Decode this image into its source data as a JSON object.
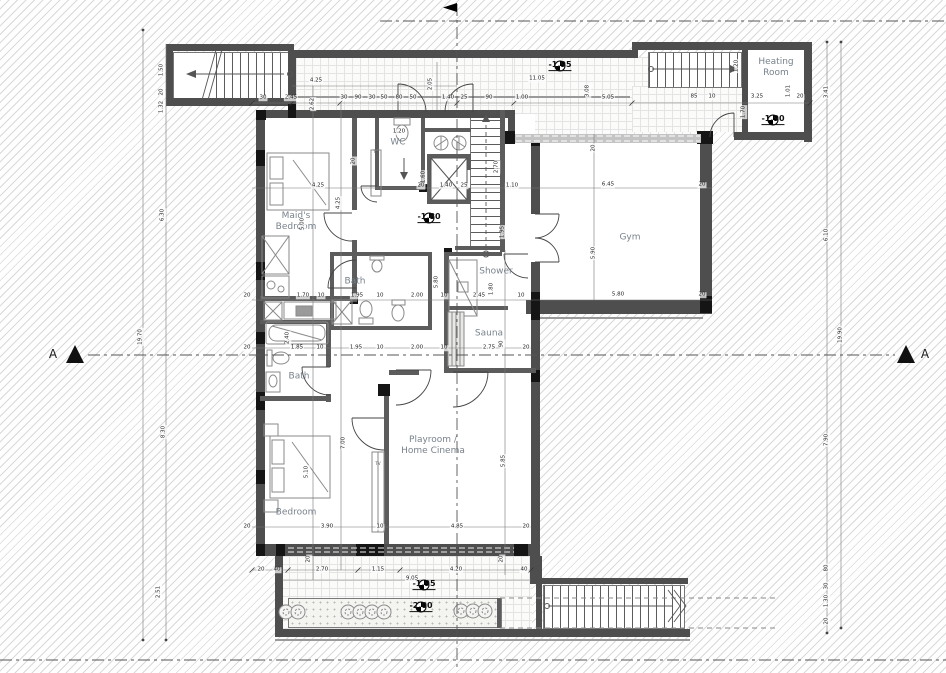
{
  "section_markers": {
    "left": "A",
    "right": "A"
  },
  "rooms": [
    {
      "id": "maids-bedroom",
      "label": "Maid's\nBedroom",
      "x": 296,
      "y": 222
    },
    {
      "id": "wc",
      "label": "WC",
      "x": 398,
      "y": 143
    },
    {
      "id": "bath-upper",
      "label": "Bath",
      "x": 355,
      "y": 282
    },
    {
      "id": "bath-lower",
      "label": "Bath",
      "x": 299,
      "y": 377
    },
    {
      "id": "shower",
      "label": "Shower",
      "x": 496,
      "y": 272
    },
    {
      "id": "sauna",
      "label": "Sauna",
      "x": 489,
      "y": 334
    },
    {
      "id": "gym",
      "label": "Gym",
      "x": 630,
      "y": 238
    },
    {
      "id": "playroom",
      "label": "Playroom /\nHome Cinema",
      "x": 433,
      "y": 446
    },
    {
      "id": "bedroom",
      "label": "Bedroom",
      "x": 296,
      "y": 513
    },
    {
      "id": "heating-room",
      "label": "Heating\nRoom",
      "x": 776,
      "y": 68
    }
  ],
  "levels": [
    {
      "text": "-1.95",
      "x": 560,
      "y": 71
    },
    {
      "text": "-1.90",
      "x": 773,
      "y": 125
    },
    {
      "text": "-1.80",
      "x": 429,
      "y": 223
    },
    {
      "text": "-1.95",
      "x": 424,
      "y": 590
    },
    {
      "text": "-2.00",
      "x": 421,
      "y": 612
    }
  ],
  "annotations": [
    {
      "t": "Manifold",
      "x": 487,
      "y": 114,
      "s": 4.5
    },
    {
      "t": "TV",
      "x": 376,
      "y": 152,
      "s": 4
    },
    {
      "t": "TV",
      "x": 378,
      "y": 464,
      "s": 4
    }
  ],
  "dimensions": [
    {
      "t": "30",
      "x": 263,
      "y": 98
    },
    {
      "t": "2.45",
      "x": 291,
      "y": 98
    },
    {
      "t": "30",
      "x": 344,
      "y": 98
    },
    {
      "t": "90",
      "x": 358,
      "y": 98
    },
    {
      "t": "30",
      "x": 372,
      "y": 98
    },
    {
      "t": "50",
      "x": 384,
      "y": 98
    },
    {
      "t": "80",
      "x": 399,
      "y": 98
    },
    {
      "t": "50",
      "x": 413,
      "y": 98
    },
    {
      "t": "1.40",
      "x": 448,
      "y": 98
    },
    {
      "t": "25",
      "x": 464,
      "y": 98
    },
    {
      "t": "90",
      "x": 489,
      "y": 98
    },
    {
      "t": "1.00",
      "x": 522,
      "y": 98
    },
    {
      "t": "5.05",
      "x": 608,
      "y": 98
    },
    {
      "t": "85",
      "x": 694,
      "y": 97
    },
    {
      "t": "10",
      "x": 712,
      "y": 97
    },
    {
      "t": "3.25",
      "x": 757,
      "y": 97
    },
    {
      "t": "20",
      "x": 800,
      "y": 97
    },
    {
      "t": "4.25",
      "x": 316,
      "y": 81
    },
    {
      "t": "2.62",
      "x": 313,
      "y": 104,
      "r": 1
    },
    {
      "t": "2.05",
      "x": 431,
      "y": 84,
      "r": 1
    },
    {
      "t": "11.05",
      "x": 537,
      "y": 79
    },
    {
      "t": "3.08",
      "x": 588,
      "y": 91,
      "r": 1
    },
    {
      "t": "1.20",
      "x": 737,
      "y": 66,
      "r": 1
    },
    {
      "t": "1.70",
      "x": 744,
      "y": 112,
      "r": 1
    },
    {
      "t": "1.01",
      "x": 789,
      "y": 91,
      "r": 1
    },
    {
      "t": "1.50",
      "x": 162,
      "y": 70,
      "r": 1
    },
    {
      "t": "20",
      "x": 162,
      "y": 92,
      "r": 1
    },
    {
      "t": "1.32",
      "x": 162,
      "y": 107,
      "r": 1
    },
    {
      "t": "6.30",
      "x": 163,
      "y": 215,
      "r": 1
    },
    {
      "t": "19.70",
      "x": 141,
      "y": 337,
      "r": 1
    },
    {
      "t": "8.30",
      "x": 164,
      "y": 432,
      "r": 1
    },
    {
      "t": "2.51",
      "x": 159,
      "y": 592,
      "r": 1
    },
    {
      "t": "3.41",
      "x": 827,
      "y": 92,
      "r": 1
    },
    {
      "t": "6.10",
      "x": 827,
      "y": 235,
      "r": 1
    },
    {
      "t": "19.90",
      "x": 841,
      "y": 335,
      "r": 1
    },
    {
      "t": "7.90",
      "x": 827,
      "y": 440,
      "r": 1
    },
    {
      "t": "80",
      "x": 827,
      "y": 568,
      "r": 1
    },
    {
      "t": "30",
      "x": 827,
      "y": 586,
      "r": 1
    },
    {
      "t": "1.30",
      "x": 827,
      "y": 601,
      "r": 1
    },
    {
      "t": "20",
      "x": 827,
      "y": 621,
      "r": 1
    },
    {
      "t": "4.25",
      "x": 318,
      "y": 186
    },
    {
      "t": "4.25",
      "x": 339,
      "y": 203,
      "r": 1
    },
    {
      "t": "5.00",
      "x": 303,
      "y": 224,
      "r": 1
    },
    {
      "t": "20",
      "x": 354,
      "y": 161,
      "r": 1
    },
    {
      "t": "1.20",
      "x": 399,
      "y": 132
    },
    {
      "t": "1.60",
      "x": 424,
      "y": 177,
      "r": 1
    },
    {
      "t": "2.70",
      "x": 497,
      "y": 167,
      "r": 1
    },
    {
      "t": "20",
      "x": 421,
      "y": 186
    },
    {
      "t": "1.40",
      "x": 446,
      "y": 186
    },
    {
      "t": "25",
      "x": 464,
      "y": 186
    },
    {
      "t": "1.10",
      "x": 512,
      "y": 186
    },
    {
      "t": "1.95",
      "x": 503,
      "y": 232,
      "r": 1
    },
    {
      "t": "20",
      "x": 594,
      "y": 148,
      "r": 1
    },
    {
      "t": "6.45",
      "x": 608,
      "y": 185
    },
    {
      "t": "20",
      "x": 702,
      "y": 185
    },
    {
      "t": "5.90",
      "x": 594,
      "y": 253,
      "r": 1
    },
    {
      "t": "5.80",
      "x": 618,
      "y": 295
    },
    {
      "t": "20",
      "x": 702,
      "y": 295
    },
    {
      "t": "20",
      "x": 247,
      "y": 296
    },
    {
      "t": "1.70",
      "x": 303,
      "y": 296
    },
    {
      "t": "10",
      "x": 321,
      "y": 296
    },
    {
      "t": "1.95",
      "x": 357,
      "y": 296
    },
    {
      "t": "10",
      "x": 380,
      "y": 296
    },
    {
      "t": "2.00",
      "x": 417,
      "y": 296
    },
    {
      "t": "10",
      "x": 444,
      "y": 296
    },
    {
      "t": "5.80",
      "x": 437,
      "y": 282,
      "r": 1
    },
    {
      "t": "2.45",
      "x": 479,
      "y": 296
    },
    {
      "t": "1.80",
      "x": 492,
      "y": 289,
      "r": 1
    },
    {
      "t": "10",
      "x": 521,
      "y": 296
    },
    {
      "t": "20",
      "x": 247,
      "y": 348
    },
    {
      "t": "1.85",
      "x": 297,
      "y": 348
    },
    {
      "t": "10",
      "x": 320,
      "y": 348
    },
    {
      "t": "1.95",
      "x": 356,
      "y": 348
    },
    {
      "t": "10",
      "x": 380,
      "y": 348
    },
    {
      "t": "2.00",
      "x": 417,
      "y": 348
    },
    {
      "t": "10",
      "x": 444,
      "y": 348
    },
    {
      "t": "2.75",
      "x": 489,
      "y": 348
    },
    {
      "t": "90",
      "x": 502,
      "y": 344,
      "r": 1
    },
    {
      "t": "20",
      "x": 526,
      "y": 348
    },
    {
      "t": "2.40",
      "x": 288,
      "y": 338,
      "r": 1
    },
    {
      "t": "7.00",
      "x": 344,
      "y": 443,
      "r": 1
    },
    {
      "t": "5.10",
      "x": 307,
      "y": 472,
      "r": 1
    },
    {
      "t": "5.85",
      "x": 504,
      "y": 461,
      "r": 1
    },
    {
      "t": "3.90",
      "x": 327,
      "y": 527
    },
    {
      "t": "10",
      "x": 380,
      "y": 527
    },
    {
      "t": "4.85",
      "x": 457,
      "y": 527
    },
    {
      "t": "20",
      "x": 247,
      "y": 527
    },
    {
      "t": "20",
      "x": 526,
      "y": 527
    },
    {
      "t": "20",
      "x": 261,
      "y": 570
    },
    {
      "t": "40",
      "x": 277,
      "y": 570
    },
    {
      "t": "2.70",
      "x": 322,
      "y": 570
    },
    {
      "t": "1.15",
      "x": 378,
      "y": 570
    },
    {
      "t": "4.20",
      "x": 456,
      "y": 570
    },
    {
      "t": "40",
      "x": 524,
      "y": 570
    },
    {
      "t": "9.05",
      "x": 412,
      "y": 579
    },
    {
      "t": "20",
      "x": 309,
      "y": 559,
      "r": 1
    },
    {
      "t": "20",
      "x": 502,
      "y": 559,
      "r": 1
    }
  ],
  "colors": {
    "wall": "#4e4e4e",
    "wall_dark": "#151515",
    "partition": "#5c5c5c",
    "hatch_line": "#d9d9d9",
    "tile_line": "#e4e4e4",
    "room_label": "#79828c",
    "dim_text": "#222222",
    "level_text": "#111111"
  }
}
